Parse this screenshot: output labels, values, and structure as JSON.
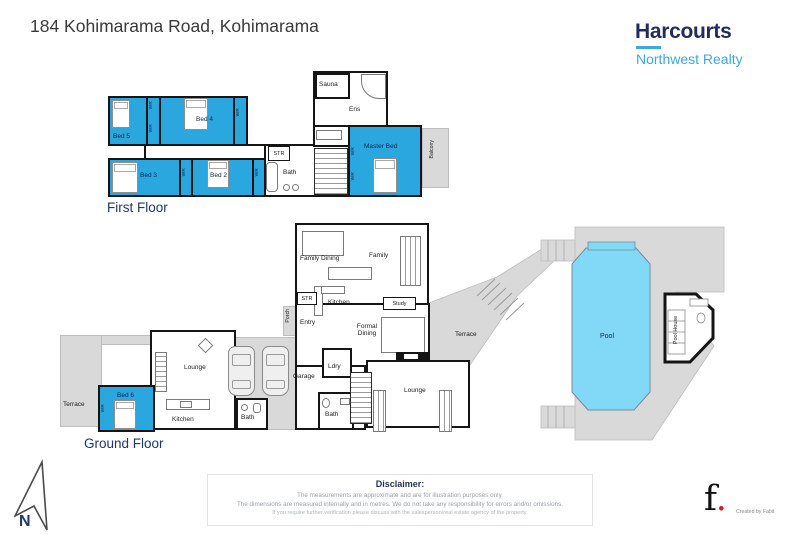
{
  "header": {
    "title": "184 Kohimarama Road, Kohimarama"
  },
  "brand": {
    "name": "Harcourts",
    "subtitle": "Northwest Realty"
  },
  "floors": {
    "first": "First Floor",
    "ground": "Ground Floor"
  },
  "labels": {
    "bed2": "Bed 2",
    "bed3": "Bed 3",
    "bed4": "Bed 4",
    "bed5": "Bed 5",
    "bed6": "Bed 6",
    "master": "Master Bed",
    "wr": "WR",
    "str": "STR",
    "bath": "Bath",
    "sauna": "Sauna",
    "ens": "Ens",
    "balcony": "Balcony",
    "family_dining": "Family Dining",
    "family": "Family",
    "kitchen": "Kitchen",
    "entry": "Entry",
    "porch": "Porch",
    "study": "Study",
    "formal_dining": "Formal Dining",
    "terrace": "Terrace",
    "ldry": "Ldry",
    "lounge": "Lounge",
    "garage": "Garage",
    "pool": "Pool",
    "pool_house": "Pool House"
  },
  "compass": {
    "label": "N"
  },
  "disclaimer": {
    "title": "Disclaimer:",
    "line1": "The measurements are approximate and are for illustration purposes only.",
    "line2": "The dimensions are measured internally and in metres. We do not take any responsibility for errors and/or omissions.",
    "line3": "If you require further verification please discuss with the salesperson/real estate agency of the property."
  },
  "credit": {
    "logo_f": "f",
    "logo_dot": ".",
    "text": "Created by Fabit"
  },
  "colors": {
    "room_blue": "#2BA7E0",
    "pool_blue": "#82D9F7",
    "area_gray": "#D9D9D9",
    "wall": "#151515",
    "brand_navy": "#232C5C",
    "brand_blue": "#3FA8DF",
    "navy_text": "#1F3864",
    "accent_red": "#D71920"
  }
}
